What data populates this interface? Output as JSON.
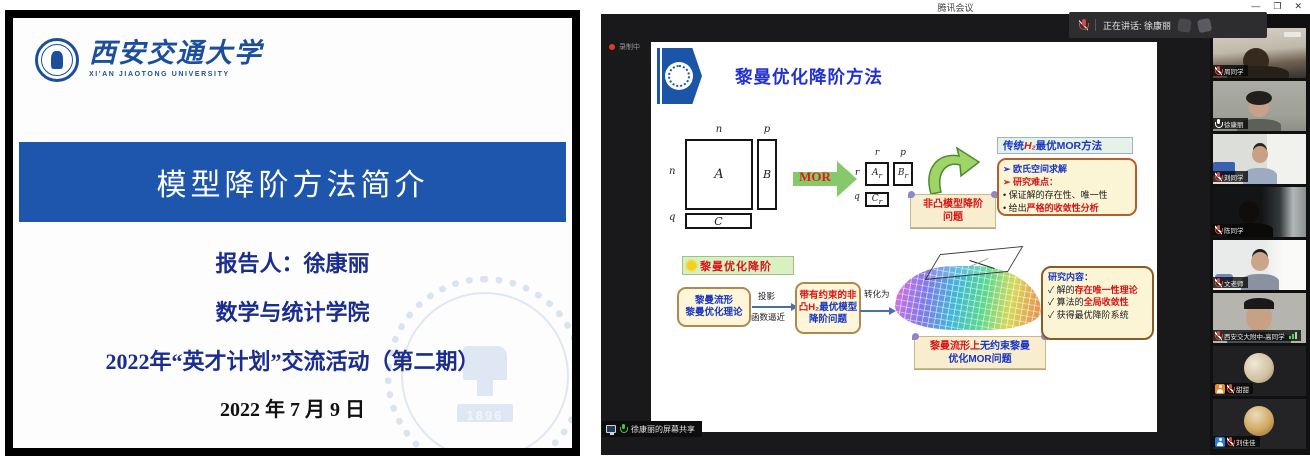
{
  "colors": {
    "xjtu_blue": "#1b4f9c",
    "title_bar_blue": "#1e56ad",
    "accent_red": "#d61515",
    "accent_blue": "#1a35c0",
    "mor_green": "#86c96b",
    "cream_box": "#fbf4d5"
  },
  "left_slide": {
    "logo": {
      "cn": "西安交通大学",
      "en": "XI'AN JIAOTONG UNIVERSITY"
    },
    "title": "模型降阶方法简介",
    "lines": {
      "presenter": "报告人：徐康丽",
      "school": "数学与统计学院",
      "event": "2022年“英才计划”交流活动（第二期）",
      "date": "2022 年 7 月 9 日"
    },
    "watermark_year": "1896"
  },
  "meeting": {
    "window_title": "腾讯会议",
    "controls": {
      "minimize": "—",
      "maximize": "❐",
      "close": "✕"
    },
    "recording_label": "录制中",
    "speaking_banner": "正在讲话: 徐康丽",
    "share_label": "徐康丽的屏幕共享",
    "slide": {
      "title": "黎曼优化降阶方法",
      "labels": {
        "n": "n",
        "p": "p",
        "q": "q",
        "r": "r",
        "A": "A",
        "B": "B",
        "C": "C",
        "sub_r": "r",
        "mor": "MOR"
      },
      "nonconvex": {
        "l1": "非凸模型降阶",
        "l2": "问题"
      },
      "traditional": {
        "hdr1": "传统",
        "hdr2": "H₂",
        "hdr3": "最优MOR方法",
        "l1": "➢ 欧氏空间求解",
        "l2": "➢ 研究难点：",
        "l3": "• 保证解的存在性、唯一性",
        "l4a": "• 给出",
        "l4b": "严格的收敛性分析"
      },
      "chip": "黎曼优化降阶",
      "flow": {
        "box1_l1": "黎曼流形",
        "box1_l2": "黎曼优化理论",
        "arrow1_top": "投影",
        "arrow1_bottom": "函数逼近",
        "box2_l1": "带有约束的非",
        "box2_l2a": "凸H₂",
        "box2_l2b": "最优模型",
        "box2_l3": "降阶问题",
        "arrow2": "转化为"
      },
      "riemann_scroll": {
        "l1a": "黎曼流形上",
        "l1b": "无约束黎曼",
        "l2": "优化MOR问题"
      },
      "research": {
        "title": "研究内容：",
        "l1a": "✓ 解的",
        "l1b": "存在唯一性理论",
        "l2a": "✓ 算法的",
        "l2b": "全局收敛性",
        "l3": "✓ 获得最优降阶系统"
      }
    },
    "participants": [
      {
        "name": "周同学",
        "mic": "muted"
      },
      {
        "name": "徐康丽",
        "mic": "on"
      },
      {
        "name": "刘同学",
        "mic": "muted"
      },
      {
        "name": "陈同学",
        "mic": "muted"
      },
      {
        "name": "文老师",
        "mic": "muted"
      },
      {
        "name": "西安交大附中-高同学",
        "mic": "muted"
      },
      {
        "name": "甜甜",
        "mic": "muted"
      },
      {
        "name": "刘佳佳",
        "mic": "muted"
      }
    ]
  }
}
